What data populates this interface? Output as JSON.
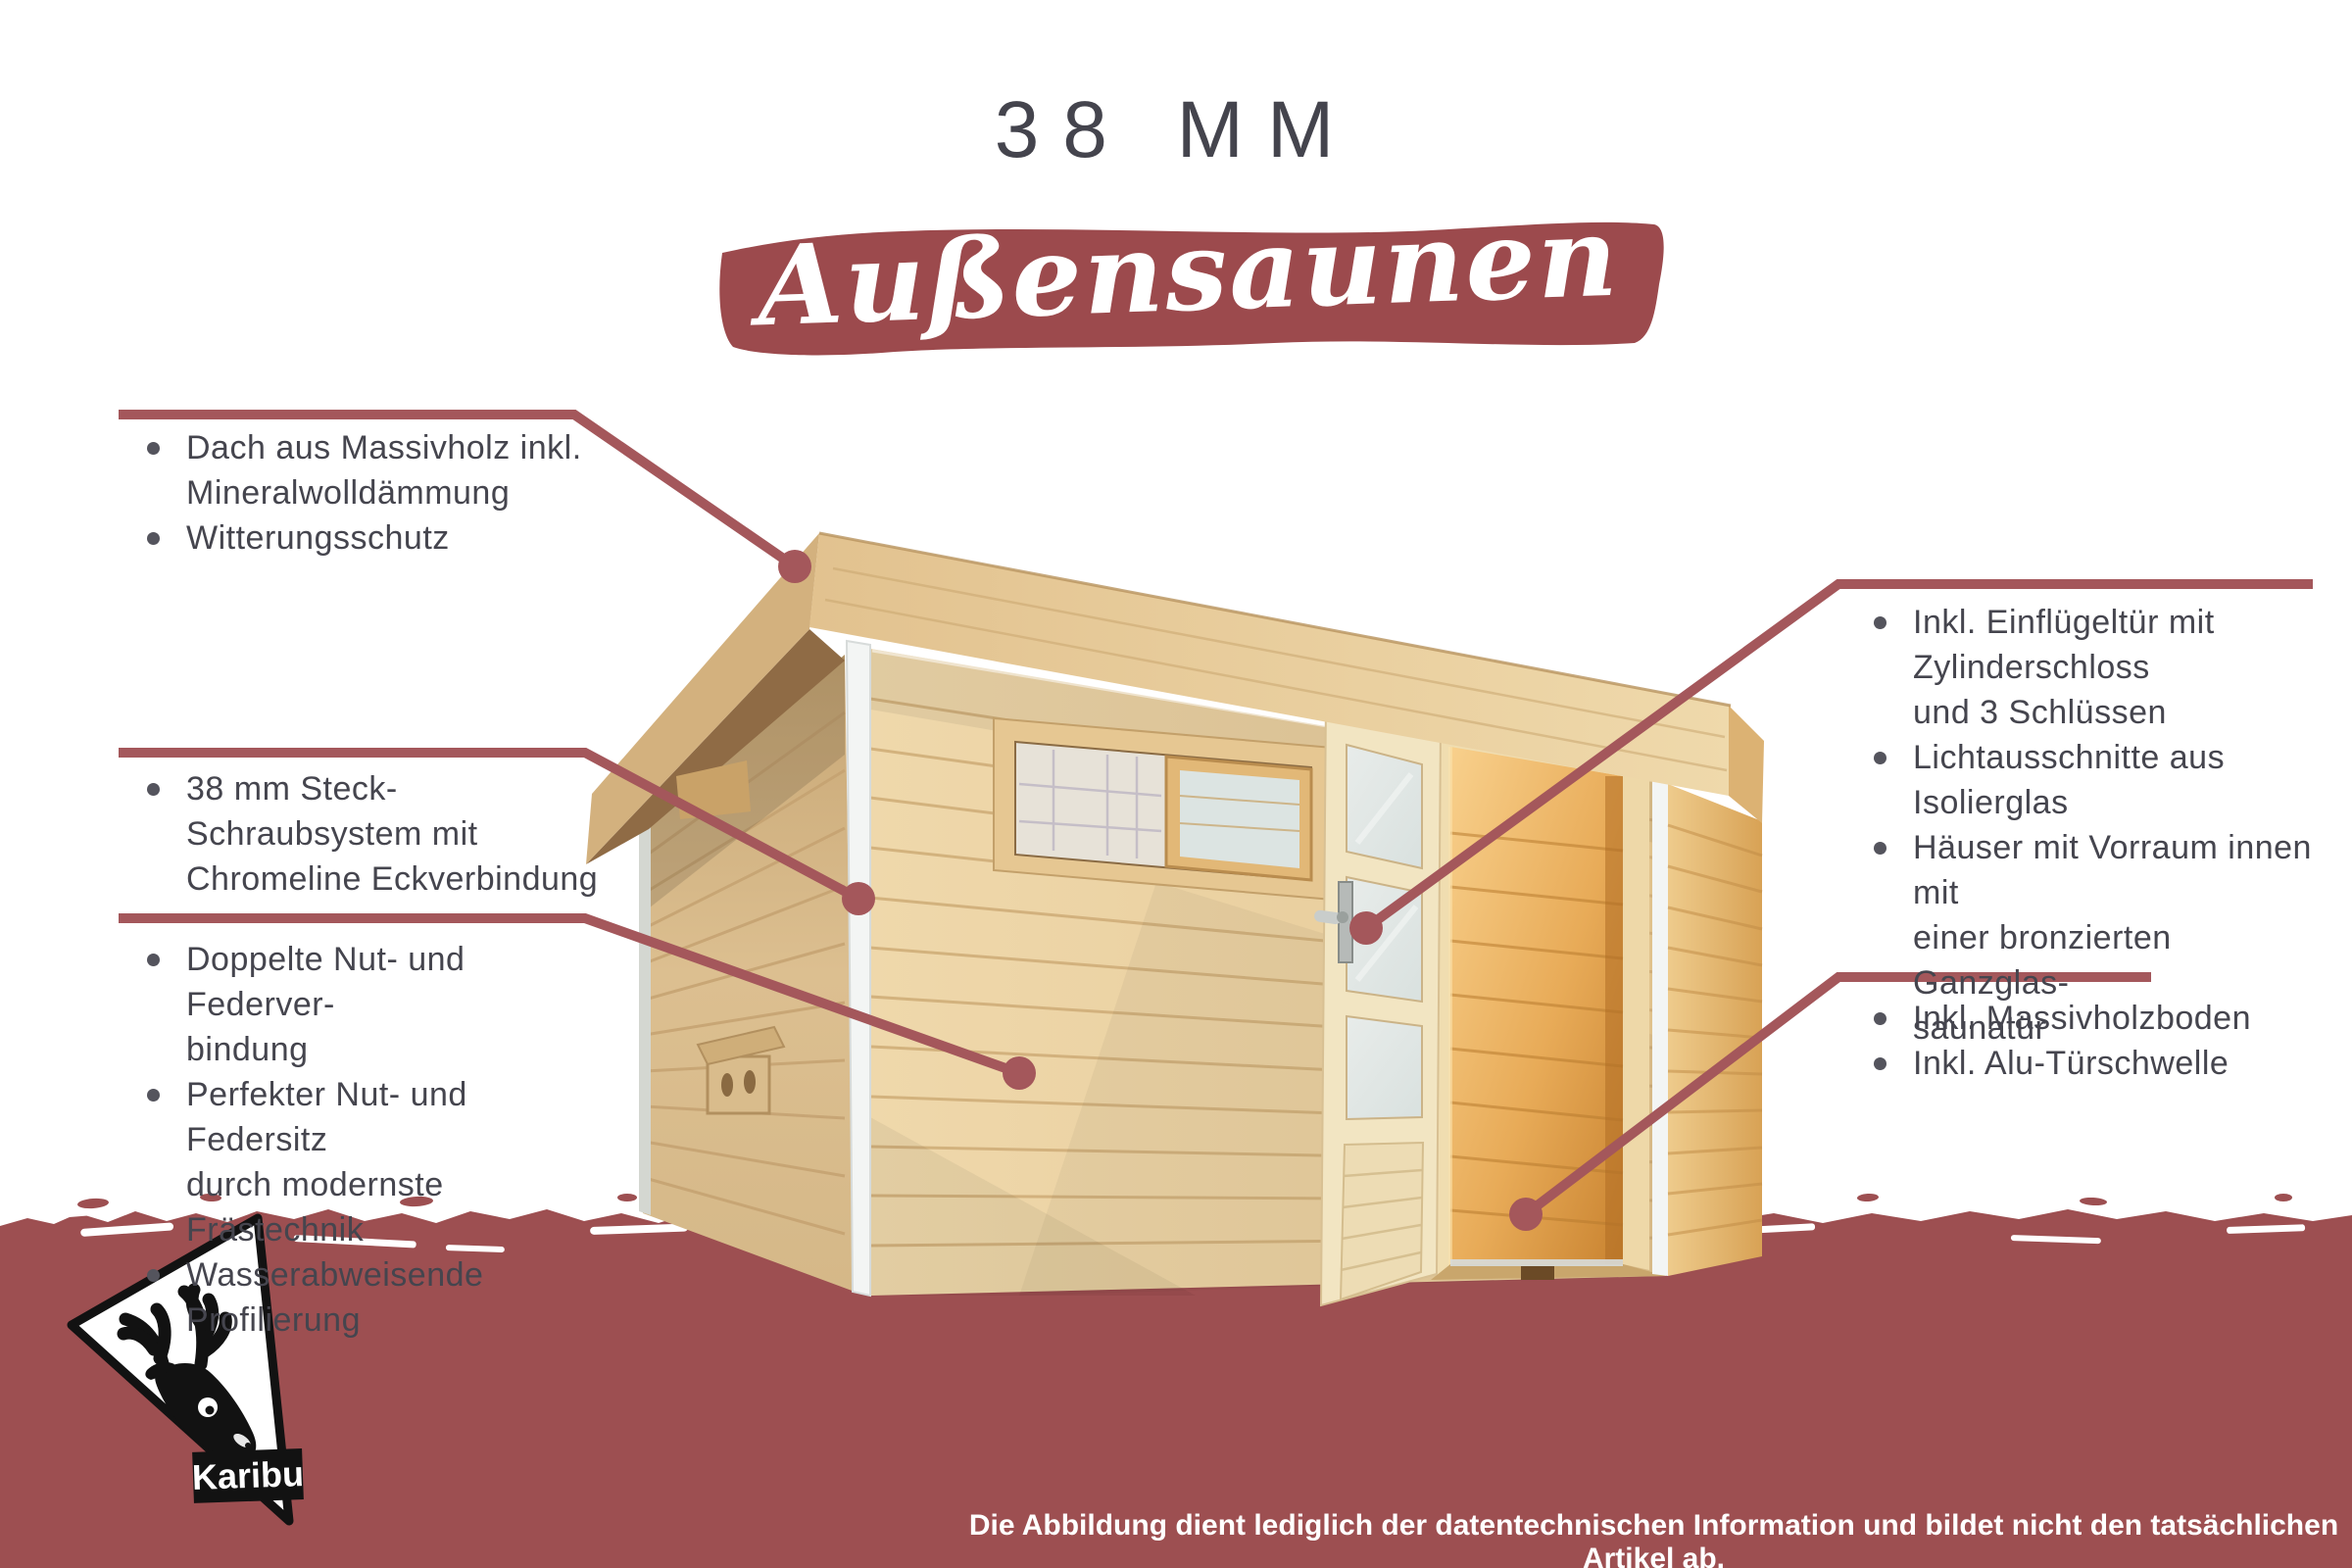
{
  "title": "38 MM",
  "banner": {
    "text": "Außensaunen"
  },
  "callouts": {
    "left": [
      {
        "lines": [
          {
            "text": "Dach aus Massivholz inkl."
          },
          {
            "text": "Mineralwolldämmung"
          },
          {
            "text": "Witterungsschutz"
          }
        ]
      },
      {
        "lines": [
          {
            "text": "38 mm Steck-Schraubsystem mit"
          },
          {
            "text": "Chromeline Eckverbindung"
          }
        ]
      },
      {
        "lines": [
          {
            "text": "Doppelte Nut- und Federver-"
          },
          {
            "text": "bindung"
          },
          {
            "text": "Perfekter Nut- und Federsitz"
          },
          {
            "text": "durch modernste Frästechnik"
          },
          {
            "text": "Wasserabweisende Profilierung"
          }
        ]
      }
    ],
    "right": [
      {
        "lines": [
          {
            "text": "Inkl. Einflügeltür mit Zylinderschloss"
          },
          {
            "text": "und 3 Schlüssen"
          },
          {
            "text": "Lichtausschnitte aus Isolierglas"
          },
          {
            "text": "Häuser mit Vorraum innen mit"
          },
          {
            "text": "einer bronzierten Ganzglas-"
          },
          {
            "text": "saunatür"
          }
        ]
      },
      {
        "lines": [
          {
            "text": "Inkl. Massivholzboden"
          },
          {
            "text": "Inkl. Alu-Türschwelle"
          }
        ]
      }
    ]
  },
  "footer": {
    "disclaimer": "Die Abbildung dient lediglich der datentechnischen Information und bildet nicht den tatsächlichen Artikel ab.",
    "brand": "Karibu"
  },
  "colors": {
    "band": "#9d4f51",
    "banner": "#9c4a4d",
    "callout_line": "#a4575b",
    "text": "#45454e",
    "banner_text": "#ffffff"
  }
}
